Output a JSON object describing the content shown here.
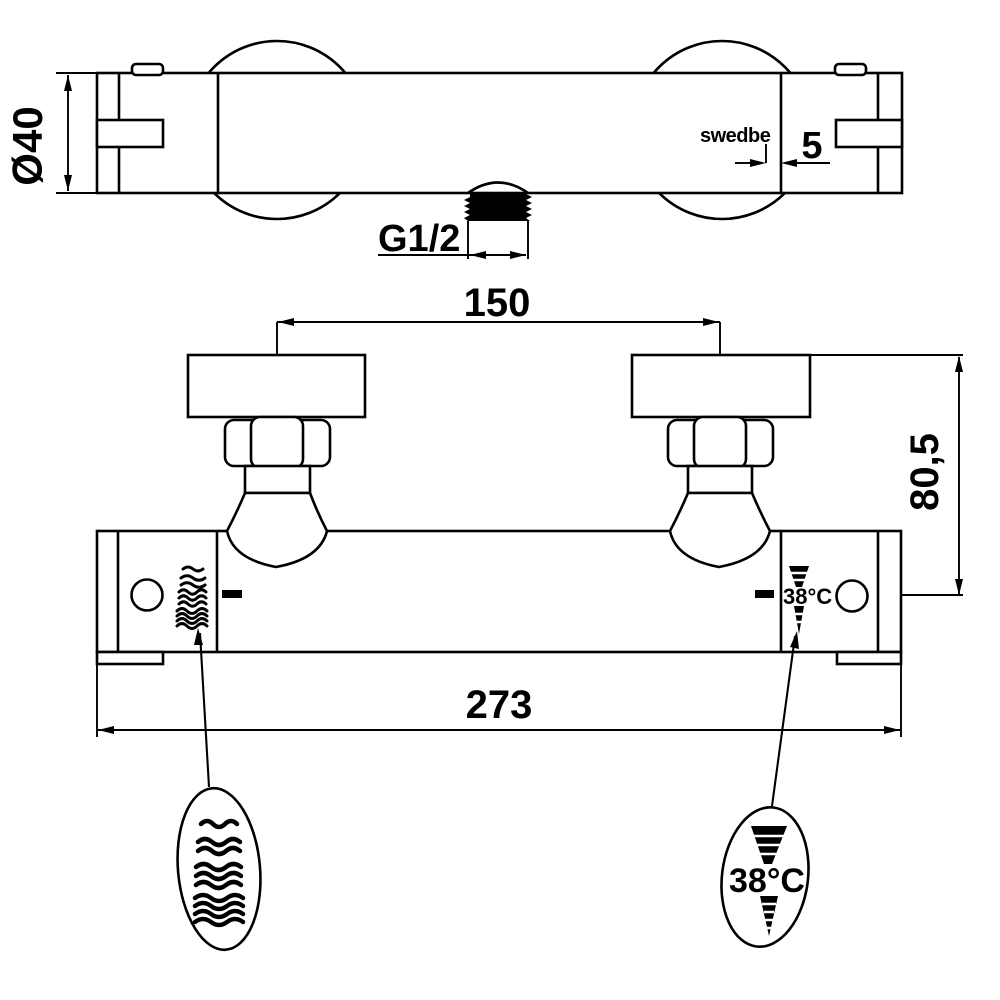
{
  "drawing": {
    "brand_label": "swedbe",
    "dimensions": {
      "body_diameter": "Ø40",
      "logo_offset": "5",
      "thread_size": "G1/2",
      "connection_spacing": "150",
      "wall_depth": "80,5",
      "total_width": "273"
    },
    "markings": {
      "body_temp_label": "38°C",
      "detail_temp_label": "38°C"
    }
  }
}
